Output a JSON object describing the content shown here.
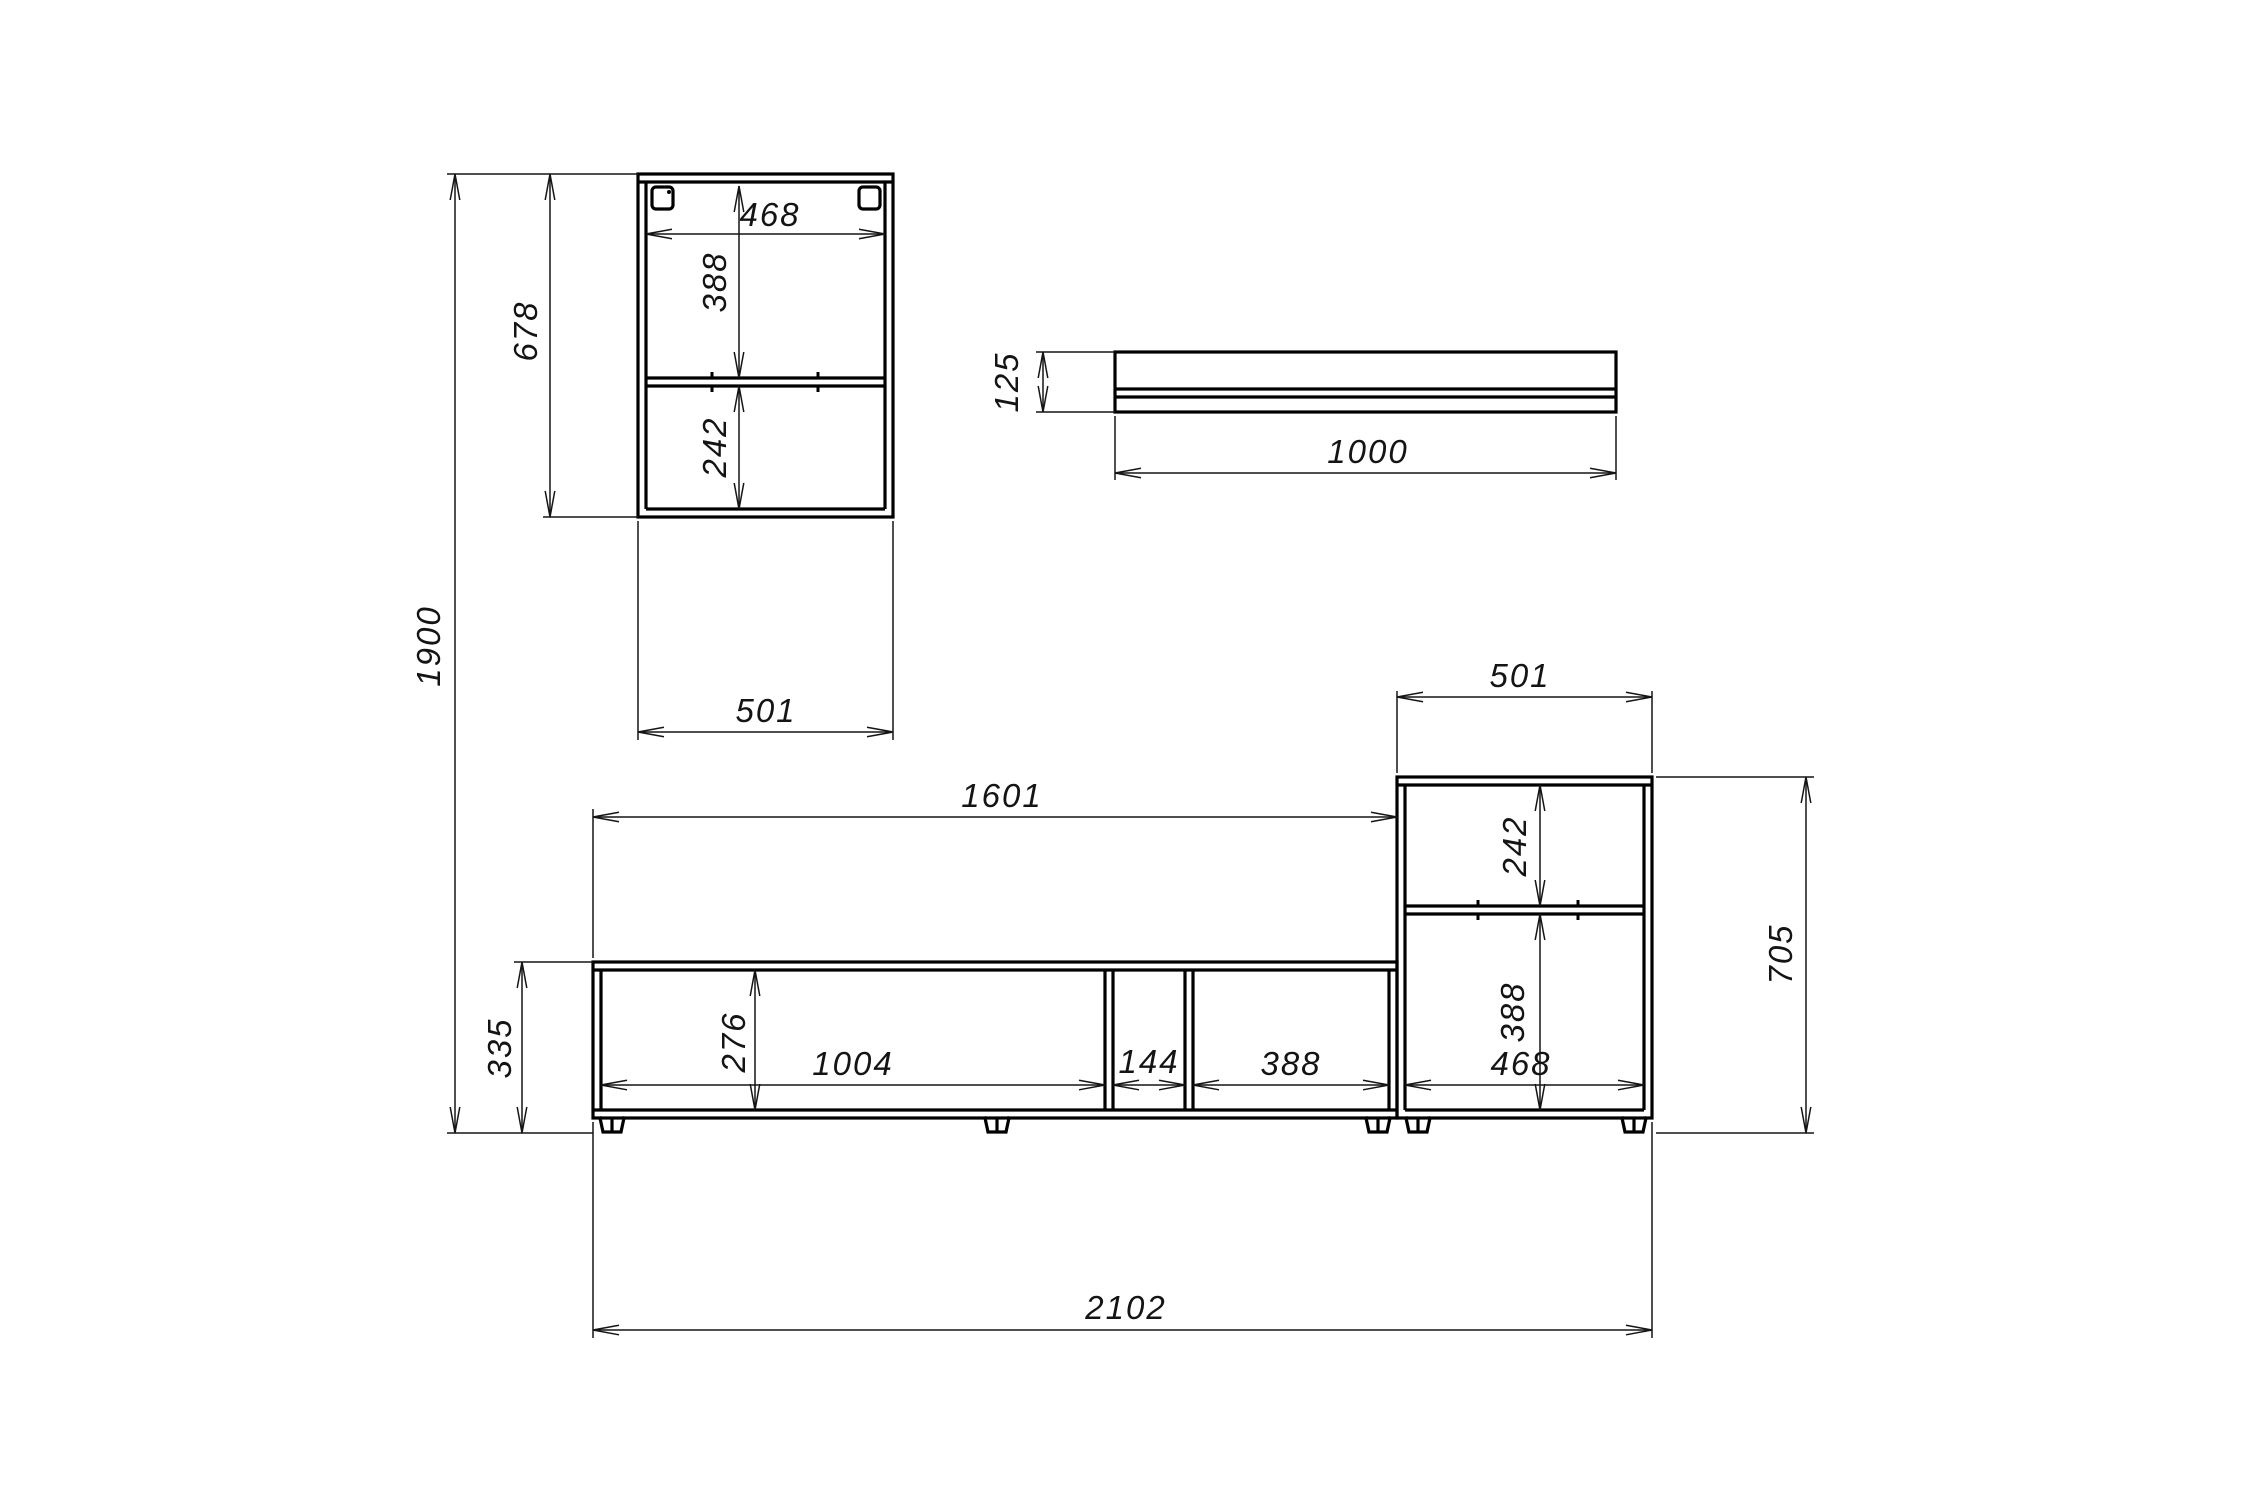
{
  "drawing": {
    "background_color": "#ffffff",
    "line_color": "#000000",
    "labels": {
      "wall_cabinet_inner_width": "468",
      "wall_cabinet_upper_compartment": "388",
      "wall_cabinet_lower_compartment": "242",
      "wall_cabinet_height": "678",
      "wall_cabinet_width": "501",
      "total_height": "1900",
      "wall_shelf_height": "125",
      "wall_shelf_length": "1000",
      "bench_length": "1601",
      "side_cabinet_width": "501",
      "side_cabinet_upper_compartment": "242",
      "side_cabinet_lower_compartment": "388",
      "side_cabinet_inner_width": "468",
      "side_cabinet_height": "705",
      "bench_height": "335",
      "bench_inner_height": "276",
      "bench_compartment_left": "1004",
      "bench_compartment_middle": "144",
      "bench_compartment_right": "388",
      "total_length": "2102"
    }
  }
}
